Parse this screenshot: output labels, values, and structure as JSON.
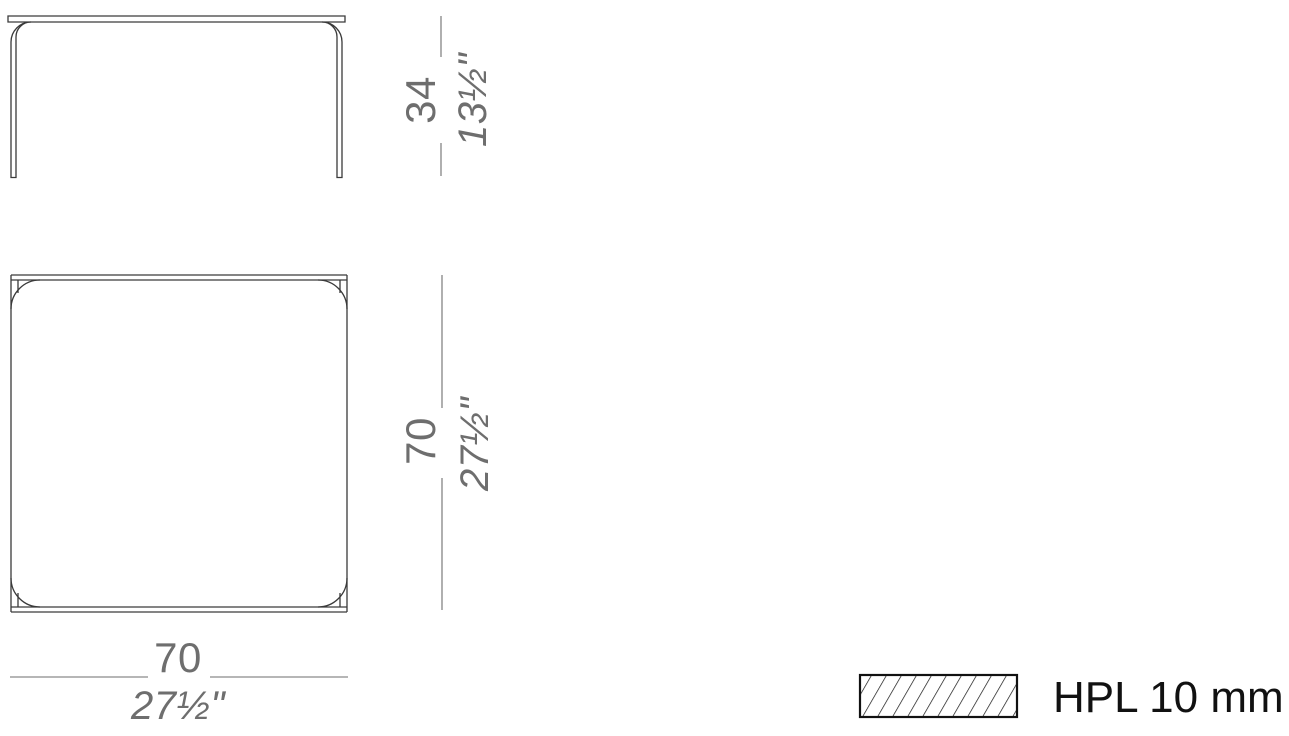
{
  "drawing": {
    "kind": "furniture-technical-drawing",
    "views": {
      "front_view": "front-elevation-of-table",
      "top_view": "plan-view-of-square-table-top"
    }
  },
  "dimensions": {
    "height": {
      "metric": "34",
      "imperial": "13½\""
    },
    "plan_depth": {
      "metric": "70",
      "imperial": "27½\""
    },
    "plan_width": {
      "metric": "70",
      "imperial": "27½\""
    }
  },
  "legend": {
    "material": "HPL 10 mm",
    "swatch_style": "diagonal-hatch"
  },
  "colors": {
    "line": "#3a3a3a",
    "dim": "#6e6e6e",
    "legend": "#111111"
  }
}
